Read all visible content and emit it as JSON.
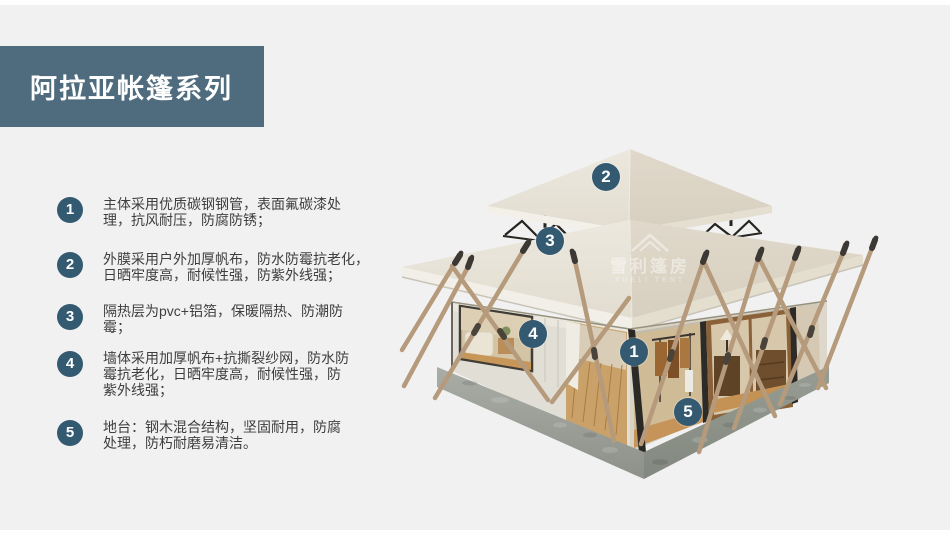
{
  "colors": {
    "page_bg": "#f1f1f2",
    "banner_bg": "#4f6c7e",
    "accent_badge": "#335a70",
    "roof_canvas": "#e8e4d9",
    "platform_gray": "#9aa09a"
  },
  "header": {
    "title": "阿拉亚帐篷系列"
  },
  "features": [
    {
      "num": "1",
      "lines": [
        "主体采用优质碳钢钢管，表面氟碳漆处",
        "理，抗风耐压，防腐防锈；"
      ]
    },
    {
      "num": "2",
      "lines": [
        "外膜采用户外加厚帆布，防水防霉抗老化，",
        "日晒牢度高，耐候性强，防紫外线强；"
      ]
    },
    {
      "num": "3",
      "lines": [
        "隔热层为pvc+铝箔，保暖隔热、防潮防",
        "霉；"
      ]
    },
    {
      "num": "4",
      "lines": [
        "墙体采用加厚帆布+抗撕裂纱网，防水防",
        "霉抗老化，日晒牢度高，耐候性强，防",
        "紫外线强；"
      ]
    },
    {
      "num": "5",
      "lines": [
        "地台：钢木混合结构，坚固耐用，防腐",
        "处理，防朽耐磨易清洁。"
      ]
    }
  ],
  "markers": [
    {
      "num": "1"
    },
    {
      "num": "2"
    },
    {
      "num": "3"
    },
    {
      "num": "4"
    },
    {
      "num": "5"
    }
  ],
  "watermark": {
    "line1": "雪利篷房",
    "line2": "XUELI TENT"
  }
}
